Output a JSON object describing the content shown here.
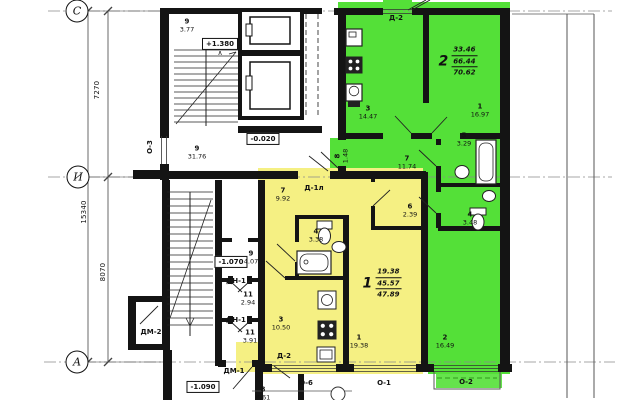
{
  "colors": {
    "yellow": "#f5f083",
    "green": "#54e038",
    "wall": "#141414",
    "thin": "#555",
    "axis": "#8a8a8a"
  },
  "axes": [
    {
      "label": "С",
      "x": 77,
      "y": 11
    },
    {
      "label": "И",
      "x": 78,
      "y": 177
    },
    {
      "label": "А",
      "x": 77,
      "y": 362
    }
  ],
  "dimensions": [
    {
      "text": "7270",
      "x": 97,
      "y": 90
    },
    {
      "text": "15340",
      "x": 84,
      "y": 212
    },
    {
      "text": "8070",
      "x": 103,
      "y": 272
    }
  ],
  "elevations": [
    {
      "text": "+1.380",
      "x": 220,
      "y": 44,
      "arrow": "up"
    },
    {
      "text": "-0.020",
      "x": 263,
      "y": 139
    },
    {
      "text": "-1.070",
      "x": 231,
      "y": 262
    },
    {
      "text": "-1.090",
      "x": 203,
      "y": 387
    }
  ],
  "doors": [
    {
      "text": "Д-2",
      "x": 396,
      "y": 18
    },
    {
      "text": "Д-1л",
      "x": 314,
      "y": 188
    },
    {
      "text": "Д-2",
      "x": 284,
      "y": 356
    },
    {
      "text": "ДМ-2",
      "x": 151,
      "y": 332
    },
    {
      "text": "ДМ-1",
      "x": 234,
      "y": 371
    },
    {
      "text": "ДН-1",
      "x": 236,
      "y": 281
    },
    {
      "text": "ДН-1",
      "x": 236,
      "y": 320
    }
  ],
  "windows": [
    {
      "text": "О-3",
      "x": 150,
      "y": 147,
      "rot": true
    },
    {
      "text": "О-6",
      "x": 306,
      "y": 383
    },
    {
      "text": "О-1",
      "x": 384,
      "y": 383
    },
    {
      "text": "О-2",
      "x": 466,
      "y": 382
    }
  ],
  "rooms": [
    {
      "n": "9",
      "a": "3.77",
      "x": 187,
      "y": 26
    },
    {
      "n": "9",
      "a": "31.76",
      "x": 197,
      "y": 153
    },
    {
      "n": "9",
      "a": "4.07",
      "x": 251,
      "y": 258
    },
    {
      "n": "11",
      "a": "2.94",
      "x": 248,
      "y": 299
    },
    {
      "n": "11",
      "a": "3.91",
      "x": 250,
      "y": 337
    },
    {
      "n": "8",
      "a": "6.61",
      "x": 263,
      "y": 394
    },
    {
      "n": "7",
      "a": "9.92",
      "x": 283,
      "y": 195
    },
    {
      "n": "4",
      "a": "3.38",
      "x": 316,
      "y": 236
    },
    {
      "n": "6",
      "a": "2.39",
      "x": 410,
      "y": 211
    },
    {
      "n": "3",
      "a": "10.50",
      "x": 281,
      "y": 324
    },
    {
      "n": "1",
      "a": "19.38",
      "x": 359,
      "y": 342
    },
    {
      "n": "3",
      "a": "14.47",
      "x": 368,
      "y": 113
    },
    {
      "n": "1",
      "a": "16.97",
      "x": 480,
      "y": 111
    },
    {
      "n": "7",
      "a": "11.74",
      "x": 407,
      "y": 163
    },
    {
      "n": "5",
      "a": "3.29",
      "x": 464,
      "y": 140
    },
    {
      "n": "4",
      "a": "3.48",
      "x": 470,
      "y": 219
    },
    {
      "n": "2",
      "a": "16.49",
      "x": 445,
      "y": 342
    },
    {
      "n": "8",
      "a": "1.48",
      "x": 342,
      "y": 156,
      "rot": true
    }
  ],
  "apartments": [
    {
      "num": "1",
      "values": [
        "19.38",
        "45.57",
        "47.89"
      ],
      "x": 382,
      "y": 283
    },
    {
      "num": "2",
      "values": [
        "33.46",
        "66.44",
        "70.62"
      ],
      "x": 458,
      "y": 61
    }
  ]
}
